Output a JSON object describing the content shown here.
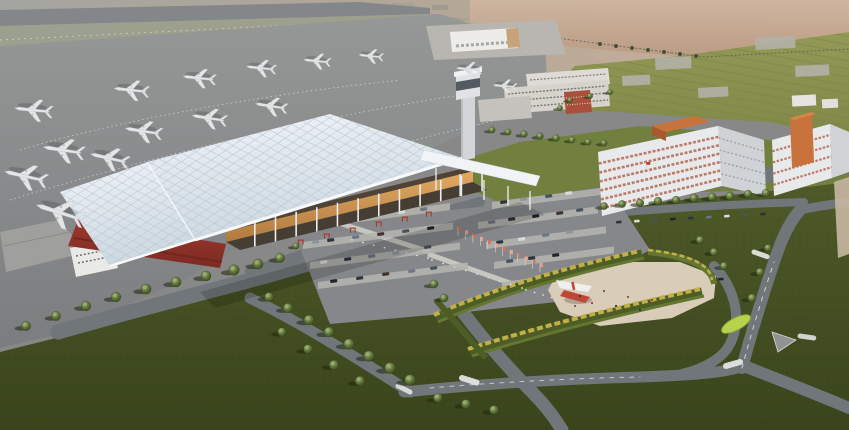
{
  "meta": {
    "title": "Aerial architectural rendering of a regional airport campus at hazy dusk",
    "type": "3d-architectural-rendering"
  },
  "palette": {
    "sky_left": "#a4a5a0",
    "sky_mid": "#b5a796",
    "sky_right": "#cdb29d",
    "pink_top": "#cfb6a1",
    "pink_bottom": "#ba9a82",
    "runway": "#84878a",
    "runway_strip": "#9ba08c",
    "apron_top": "#969897",
    "apron_bottom": "#7b7d80",
    "field_top": "#949a56",
    "field_bottom": "#7f8748",
    "field_row": "#7a8242",
    "shed": "#b2b1a8",
    "fence": "#5c5f52",
    "grass_top": "#4e5a28",
    "grass_bottom": "#39441c",
    "lawn_mid": "#72803f",
    "road": "#71767a",
    "marking": "#e9ebea",
    "parking": "#85878b",
    "strip": "#b3b4ad",
    "median": "#5d6b33",
    "walkway": "#c6c7c0",
    "plaza": "#d9cdb9",
    "hedge_green": "#64762f",
    "hedge_yellow": "#c2af4a",
    "hedge_dark": "#4c5d25",
    "tree_shadow": "#20270f",
    "roof_hi": "#f0f4f7",
    "roof_lo": "#cdd8e1",
    "lattice": "#b7c4d1",
    "fascia": "#f7f9fa",
    "red_annex": "#9c382c",
    "red_annex_dark": "#7c2b22",
    "facade_hi": "#e6ad66",
    "facade_lo": "#b07a3e",
    "recess": "#463d33",
    "column": "#eceef0",
    "glass_dark": "#4e4336",
    "logo_red": "#c03a2a",
    "tower_body": "#d3d6d9",
    "tower_cap": "#e0e3e5",
    "tower_dark": "#545a62",
    "bldg_white": "#dddbd6",
    "bldg_grey": "#c4c2bd",
    "bldg_red": "#a8503c",
    "win_dark": "#5c564e",
    "hotel_face": "#e8e9eb",
    "hotel_side": "#cfd3d6",
    "hotel_roof": "#c7cbce",
    "hotel_win": "#b0624a",
    "hotel_win2": "#8d949c",
    "hotel_orange": "#c8723c",
    "hotel_orange_dark": "#a85a2e",
    "hotel_orange_hi": "#d8854a",
    "tan_bldg": "#c9b7a2",
    "plane_body": "#e3e6e7",
    "plane_shade": "#b9bec1",
    "bollard": "#f0f1ee",
    "sculpt_red": "#c04636",
    "sculpt_white": "#eff0ee",
    "leaf": "#b9d24e",
    "leaf_dark": "#8fae35",
    "cargo_white": "#edece8",
    "cargo_tan": "#c8a37a",
    "pad": "#b7b6b0",
    "island": "#90938f",
    "car_colors": [
      "#2c333d",
      "#49525f",
      "#6b7585",
      "#20252c",
      "#8d959e",
      "#d9dbdc",
      "#40342c"
    ],
    "people_colors": [
      "#30343a",
      "#b03a2e",
      "#5a6066",
      "#8a4a3a"
    ],
    "flag_colors": [
      "#d8705c",
      "#e8a088"
    ]
  },
  "scene": {
    "labels": {
      "terminal": "passenger-terminal",
      "tower": "control-tower",
      "apron": "aircraft-apron",
      "runway": "runway",
      "cargo": "cargo-facility",
      "hotels": "airport-hotel-offices",
      "admin": "administration-complex",
      "parking": "surface-parking-lot",
      "plaza": "landscape-plaza-with-sculpture",
      "fields": "farm-fields",
      "roads": "access-roads"
    },
    "aircraft": [
      [
        32,
        110,
        0.92,
        186
      ],
      [
        130,
        90,
        0.85,
        186
      ],
      [
        198,
        78,
        0.8,
        186
      ],
      [
        260,
        68,
        0.72,
        186
      ],
      [
        316,
        61,
        0.66,
        186
      ],
      [
        370,
        56,
        0.6,
        186
      ],
      [
        468,
        69,
        0.62,
        185
      ],
      [
        504,
        86,
        0.58,
        185
      ],
      [
        62,
        150,
        1.0,
        189
      ],
      [
        142,
        131,
        0.9,
        189
      ],
      [
        208,
        118,
        0.85,
        189
      ],
      [
        270,
        106,
        0.78,
        189
      ],
      [
        24,
        176,
        1.05,
        193
      ],
      [
        108,
        158,
        0.95,
        193
      ],
      [
        58,
        212,
        1.2,
        198
      ]
    ],
    "trees": [
      [
        26,
        326,
        1.0
      ],
      [
        56,
        316,
        1.0
      ],
      [
        86,
        306,
        1.05
      ],
      [
        116,
        297,
        1.05
      ],
      [
        146,
        289,
        1.1
      ],
      [
        176,
        282,
        1.1
      ],
      [
        206,
        276,
        1.1
      ],
      [
        234,
        270,
        1.15
      ],
      [
        258,
        264,
        1.1
      ],
      [
        280,
        258,
        1.0
      ],
      [
        269,
        297,
        1.0
      ],
      [
        288,
        308,
        1.05
      ],
      [
        309,
        320,
        1.1
      ],
      [
        329,
        332,
        1.1
      ],
      [
        349,
        344,
        1.15
      ],
      [
        369,
        356,
        1.15
      ],
      [
        390,
        368,
        1.2
      ],
      [
        410,
        380,
        1.2
      ],
      [
        282,
        332,
        0.95
      ],
      [
        308,
        349,
        1.0
      ],
      [
        334,
        365,
        1.05
      ],
      [
        360,
        381,
        1.05
      ],
      [
        438,
        398,
        1.0
      ],
      [
        466,
        404,
        1.0
      ],
      [
        494,
        410,
        1.0
      ],
      [
        604,
        206,
        0.8
      ],
      [
        622,
        204,
        0.8
      ],
      [
        640,
        203,
        0.85
      ],
      [
        658,
        201,
        0.85
      ],
      [
        676,
        200,
        0.85
      ],
      [
        694,
        198,
        0.9
      ],
      [
        712,
        197,
        0.9
      ],
      [
        730,
        196,
        0.9
      ],
      [
        748,
        194,
        0.85
      ],
      [
        766,
        193,
        0.85
      ],
      [
        492,
        130,
        0.7
      ],
      [
        508,
        132,
        0.7
      ],
      [
        524,
        134,
        0.75
      ],
      [
        540,
        136,
        0.75
      ],
      [
        556,
        138,
        0.75
      ],
      [
        572,
        140,
        0.7
      ],
      [
        588,
        142,
        0.7
      ],
      [
        604,
        143,
        0.7
      ],
      [
        752,
        298,
        0.9
      ],
      [
        760,
        272,
        0.85
      ],
      [
        768,
        248,
        0.8
      ],
      [
        434,
        284,
        0.9
      ],
      [
        444,
        298,
        0.9
      ],
      [
        296,
        246,
        0.7
      ],
      [
        570,
        100,
        0.6
      ],
      [
        590,
        96,
        0.6
      ],
      [
        610,
        92,
        0.6
      ],
      [
        560,
        108,
        0.6
      ],
      [
        700,
        240,
        0.85
      ],
      [
        714,
        252,
        0.85
      ],
      [
        724,
        266,
        0.85
      ]
    ],
    "terminal": {
      "columns": {
        "n": 12,
        "t0": 0.06,
        "t1": 0.98,
        "base": [
          240,
          250,
          487,
          190
        ],
        "h0": 26,
        "h1": 20
      }
    },
    "parking": {
      "strips": [
        [
          320,
          220,
          130
        ],
        [
          303,
          242,
          150
        ],
        [
          310,
          262,
          150
        ],
        [
          318,
          282,
          150
        ],
        [
          492,
          202,
          110
        ],
        [
          478,
          222,
          120
        ],
        [
          486,
          242,
          120
        ],
        [
          494,
          262,
          120
        ],
        [
          502,
          282,
          120
        ]
      ],
      "cars": [
        [
          330,
          219,
          0
        ],
        [
          345,
          217,
          3
        ],
        [
          372,
          214,
          1
        ],
        [
          398,
          211,
          5
        ],
        [
          420,
          208,
          2
        ],
        [
          312,
          241,
          4
        ],
        [
          327,
          239,
          0
        ],
        [
          352,
          236,
          2
        ],
        [
          377,
          233,
          6
        ],
        [
          402,
          230,
          1
        ],
        [
          427,
          227,
          3
        ],
        [
          320,
          261,
          5
        ],
        [
          344,
          258,
          0
        ],
        [
          368,
          255,
          2
        ],
        [
          392,
          252,
          4
        ],
        [
          424,
          246,
          1
        ],
        [
          330,
          280,
          3
        ],
        [
          356,
          277,
          0
        ],
        [
          382,
          273,
          6
        ],
        [
          408,
          270,
          2
        ],
        [
          430,
          267,
          1
        ],
        [
          500,
          201,
          0
        ],
        [
          520,
          198,
          4
        ],
        [
          545,
          195,
          1
        ],
        [
          565,
          192,
          5
        ],
        [
          488,
          221,
          2
        ],
        [
          508,
          218,
          0
        ],
        [
          532,
          215,
          3
        ],
        [
          556,
          212,
          6
        ],
        [
          576,
          209,
          1
        ],
        [
          496,
          241,
          0
        ],
        [
          518,
          238,
          5
        ],
        [
          542,
          234,
          2
        ],
        [
          566,
          231,
          4
        ],
        [
          506,
          260,
          1
        ],
        [
          528,
          257,
          0
        ],
        [
          552,
          254,
          3
        ]
      ]
    },
    "roads": {
      "cars": [
        [
          616,
          221,
          0
        ],
        [
          634,
          220,
          5
        ],
        [
          652,
          219,
          1
        ],
        [
          670,
          218,
          3
        ],
        [
          688,
          217,
          0
        ],
        [
          706,
          216,
          2
        ],
        [
          724,
          215,
          5
        ],
        [
          742,
          214,
          1
        ],
        [
          760,
          213,
          0
        ],
        [
          718,
          278,
          3
        ]
      ]
    },
    "flags": {
      "x1": 458,
      "y1": 236,
      "x2": 540,
      "y2": 272,
      "n": 12
    },
    "bollards": [
      {
        "x1": 352,
        "y1": 240,
        "x2": 428,
        "y2": 258,
        "n": 8
      },
      {
        "x1": 432,
        "y1": 260,
        "x2": 522,
        "y2": 288,
        "n": 9
      },
      {
        "x1": 526,
        "y1": 290,
        "x2": 560,
        "y2": 300,
        "n": 5
      }
    ],
    "people": [
      [
        580,
        296,
        0
      ],
      [
        592,
        303,
        1
      ],
      [
        604,
        291,
        2
      ],
      [
        616,
        306,
        0
      ],
      [
        628,
        297,
        3
      ],
      [
        640,
        310,
        0
      ],
      [
        575,
        306,
        2
      ],
      [
        652,
        300,
        1
      ]
    ],
    "sheds": [
      [
        655,
        58,
        36,
        12
      ],
      [
        755,
        38,
        40,
        12
      ],
      [
        795,
        66,
        34,
        11
      ],
      [
        698,
        88,
        30,
        10
      ],
      [
        622,
        76,
        28,
        10
      ]
    ],
    "gates": [
      [
        298,
        240
      ],
      [
        324,
        234
      ],
      [
        350,
        228
      ],
      [
        376,
        222
      ],
      [
        402,
        217
      ],
      [
        426,
        212
      ]
    ]
  }
}
